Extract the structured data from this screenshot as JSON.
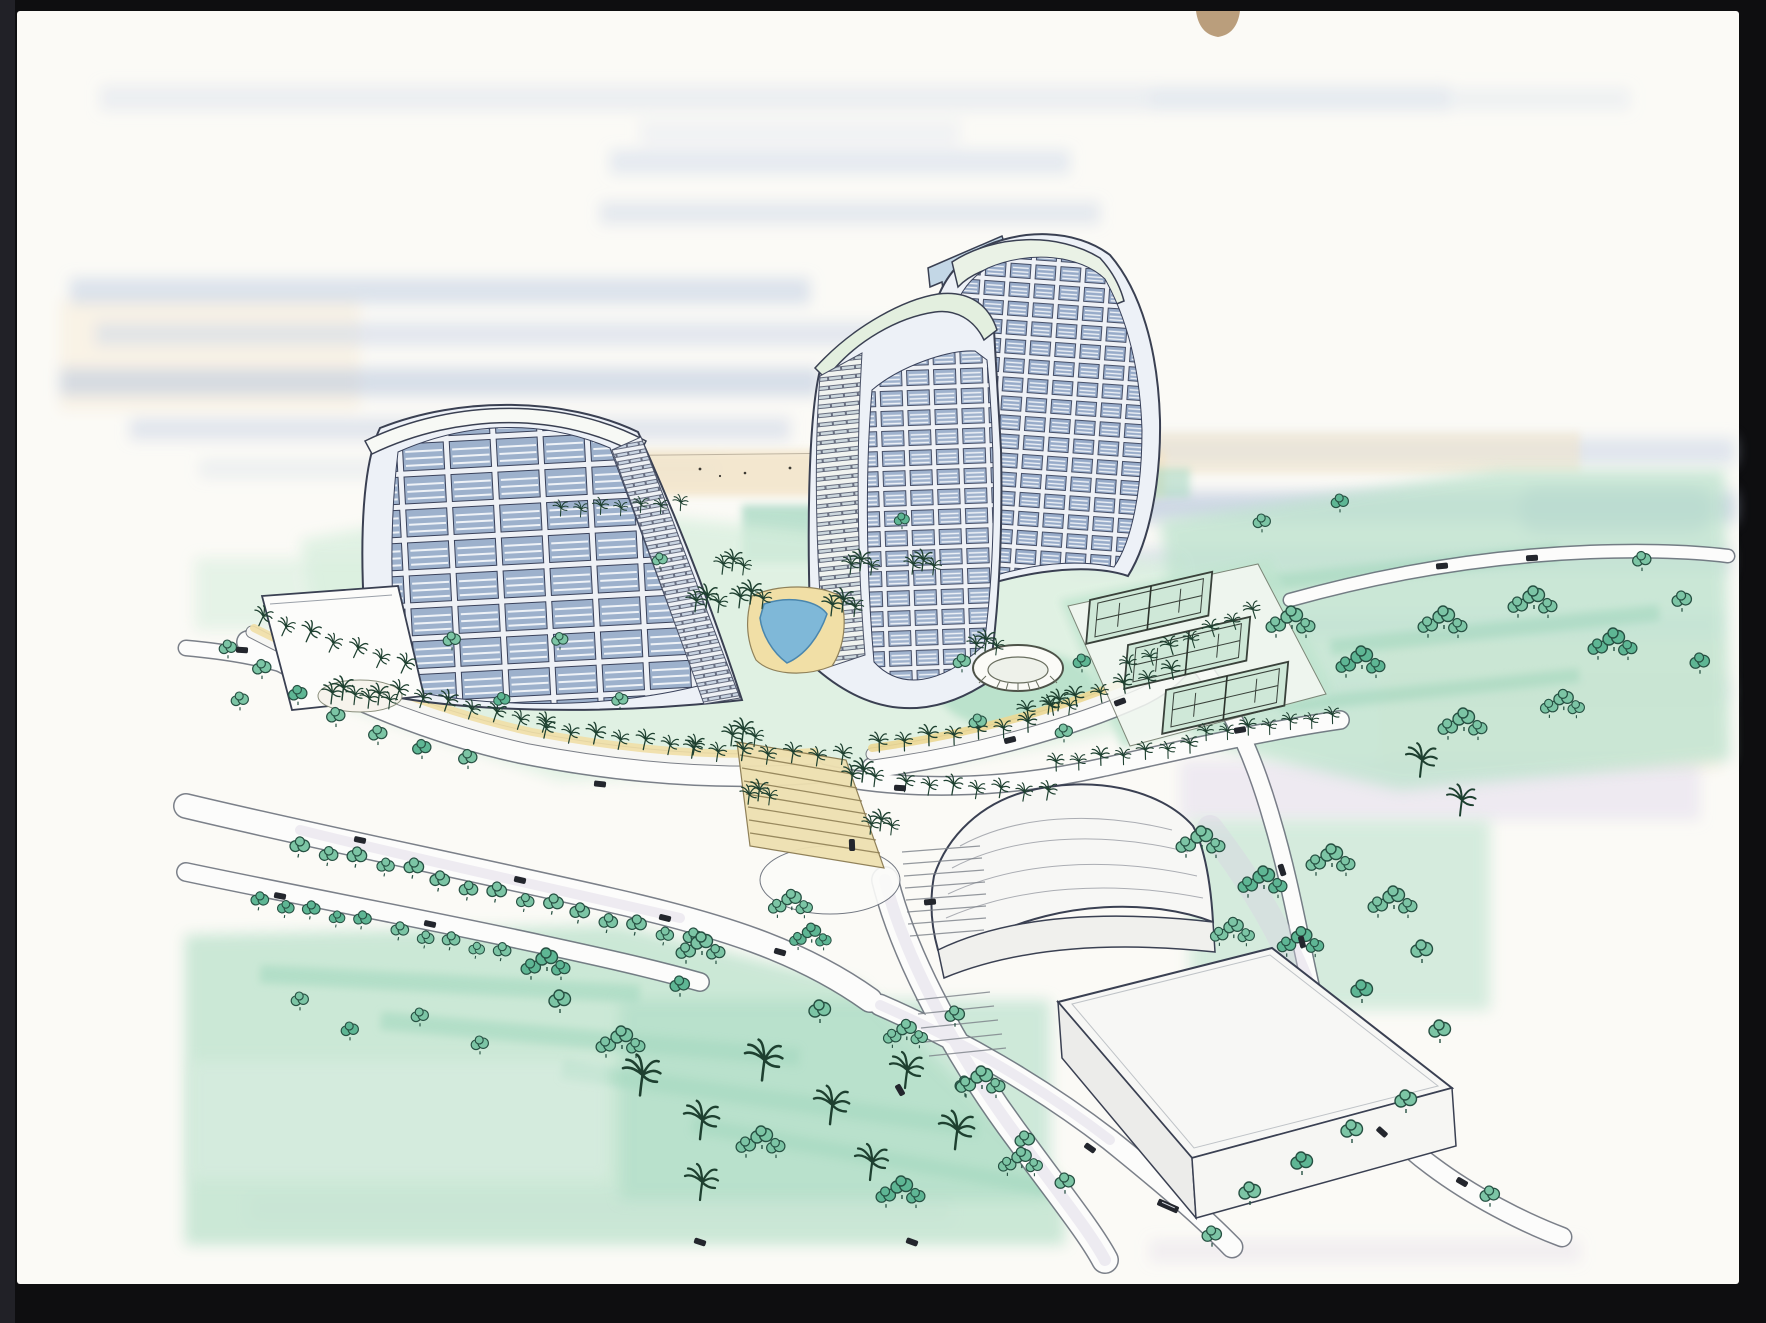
{
  "meta": {
    "title": "Aerial watercolor concept rendering of a coastal resort with three curved sail-shaped towers",
    "medium": "ink and watercolor on white paper, photographed on a black background",
    "view": "bird's-eye perspective"
  },
  "palette": {
    "frame": "#0e0e10",
    "frame_edge": "#212127",
    "paper": "#fbfaf6",
    "sky_blue": "#bdcbe1",
    "sky_deep": "#9fb2d0",
    "lavender": "#d9d2e4",
    "sand": "#f2e3c6",
    "cream": "#f7ecd9",
    "lawn": "#bfe3cf",
    "lawn_deep": "#97d2b6",
    "tree": "#7cc5a5",
    "tree_dark": "#5eb694",
    "palm_ink": "#1e4030",
    "ink": "#3a4052",
    "tower_body": "#edf1f7",
    "window_cell": "#9db1cc",
    "louver": "#c9d4e2",
    "mint": "#e3efdf",
    "pool": "#7fb8d8",
    "deck": "#f1dfa6",
    "steps": "#eee0b0",
    "road": "#fcfcfb",
    "roof": "#f7f7f5",
    "car": "#23262d",
    "clip_tan": "#b3946f"
  },
  "scene": {
    "towers": {
      "count": 3,
      "style": "curved sail-shaped high-rise towers with louvered window grids"
    },
    "amenities": {
      "tennis_courts": 3,
      "swimming_pool": 1,
      "amphitheater": 1,
      "grand_stair": 1
    },
    "buildings": {
      "vaulted_hall": 1,
      "flat_roof_hall": 1,
      "arrival_pavilion": 1
    },
    "landscape": {
      "palm_promenade": true,
      "tree_lined_roads": true,
      "lawns": true,
      "beach_horizon": true
    }
  }
}
